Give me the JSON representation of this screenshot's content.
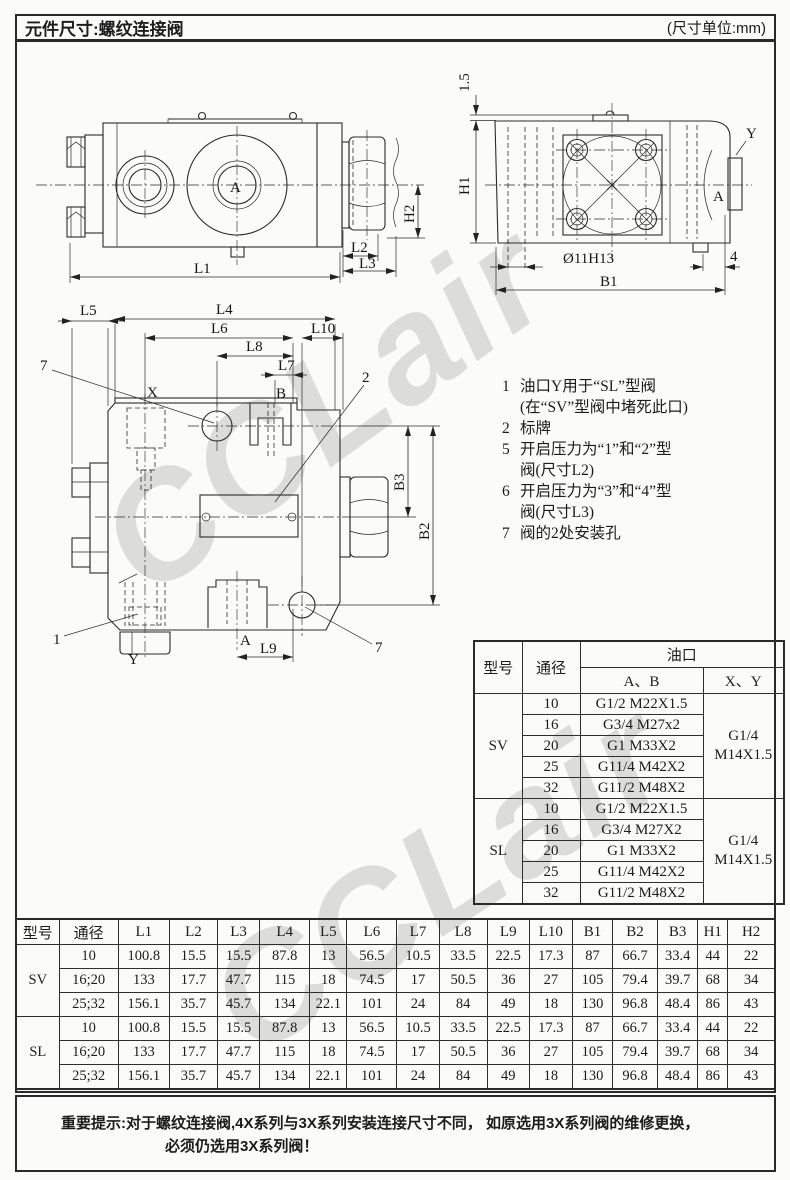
{
  "header": {
    "title": "元件尺寸:螺纹连接阀",
    "unit": "(尺寸单位:mm)"
  },
  "watermark": "CCLair",
  "drawings": {
    "side_view": {
      "labels": {
        "A": "A",
        "L1": "L1",
        "L2": "L2",
        "L3": "L3",
        "H2": "H2"
      }
    },
    "end_view": {
      "labels": {
        "gap": "1.5",
        "H1": "H1",
        "hole": "Ø11H13",
        "B1": "B1",
        "offset4": "4",
        "Y": "Y",
        "A": "A"
      }
    },
    "front_view": {
      "labels": {
        "L4": "L4",
        "L5": "L5",
        "L6": "L6",
        "L7": "L7",
        "L8": "L8",
        "L9": "L9",
        "L10": "L10",
        "B2": "B2",
        "B3": "B3",
        "X": "X",
        "B": "B",
        "A": "A",
        "Y": "Y",
        "c1": "1",
        "c2": "2",
        "c7": "7"
      }
    }
  },
  "notes": [
    {
      "num": "1",
      "lines": [
        "油口Y用于“SL”型阀",
        "(在“SV”型阀中堵死此口)"
      ]
    },
    {
      "num": "2",
      "lines": [
        "标牌"
      ]
    },
    {
      "num": "5",
      "lines": [
        "开启压力为“1”和“2”型",
        "阀(尺寸L2)"
      ]
    },
    {
      "num": "6",
      "lines": [
        "开启压力为“3”和“4”型",
        "阀(尺寸L3)"
      ]
    },
    {
      "num": "7",
      "lines": [
        "阀的2处安装孔"
      ]
    }
  ],
  "port_table": {
    "headers": {
      "model": "型号",
      "size": "通径",
      "port": "油口",
      "ab": "A、B",
      "xy": "X、Y"
    },
    "groups": [
      {
        "model": "SV",
        "xy": [
          "G1/4",
          "M14X1.5"
        ],
        "rows": [
          [
            "10",
            "G1/2 M22X1.5"
          ],
          [
            "16",
            "G3/4 M27x2"
          ],
          [
            "20",
            "G1 M33X2"
          ],
          [
            "25",
            "G11/4 M42X2"
          ],
          [
            "32",
            "G11/2 M48X2"
          ]
        ]
      },
      {
        "model": "SL",
        "xy": [
          "G1/4",
          "M14X1.5"
        ],
        "rows": [
          [
            "10",
            "G1/2 M22X1.5"
          ],
          [
            "16",
            "G3/4 M27X2"
          ],
          [
            "20",
            "G1 M33X2"
          ],
          [
            "25",
            "G11/4 M42X2"
          ],
          [
            "32",
            "G11/2 M48X2"
          ]
        ]
      }
    ]
  },
  "dim_table": {
    "headers": [
      "型号",
      "通径",
      "L1",
      "L2",
      "L3",
      "L4",
      "L5",
      "L6",
      "L7",
      "L8",
      "L9",
      "L10",
      "B1",
      "B2",
      "B3",
      "H1",
      "H2"
    ],
    "groups": [
      {
        "model": "SV",
        "rows": [
          [
            "10",
            "100.8",
            "15.5",
            "15.5",
            "87.8",
            "13",
            "56.5",
            "10.5",
            "33.5",
            "22.5",
            "17.3",
            "87",
            "66.7",
            "33.4",
            "44",
            "22"
          ],
          [
            "16;20",
            "133",
            "17.7",
            "47.7",
            "115",
            "18",
            "74.5",
            "17",
            "50.5",
            "36",
            "27",
            "105",
            "79.4",
            "39.7",
            "68",
            "34"
          ],
          [
            "25;32",
            "156.1",
            "35.7",
            "45.7",
            "134",
            "22.1",
            "101",
            "24",
            "84",
            "49",
            "18",
            "130",
            "96.8",
            "48.4",
            "86",
            "43"
          ]
        ]
      },
      {
        "model": "SL",
        "rows": [
          [
            "10",
            "100.8",
            "15.5",
            "15.5",
            "87.8",
            "13",
            "56.5",
            "10.5",
            "33.5",
            "22.5",
            "17.3",
            "87",
            "66.7",
            "33.4",
            "44",
            "22"
          ],
          [
            "16;20",
            "133",
            "17.7",
            "47.7",
            "115",
            "18",
            "74.5",
            "17",
            "50.5",
            "36",
            "27",
            "105",
            "79.4",
            "39.7",
            "68",
            "34"
          ],
          [
            "25;32",
            "156.1",
            "35.7",
            "45.7",
            "134",
            "22.1",
            "101",
            "24",
            "84",
            "49",
            "18",
            "130",
            "96.8",
            "48.4",
            "86",
            "43"
          ]
        ]
      }
    ]
  },
  "warning": {
    "prefix": "重要提示:",
    "line1": "对于螺纹连接阀,4X系列与3X系列安装连接尺寸不同， 如原选用3X系列阀的维修更换，",
    "line2": "必须仍选用3X系列阀！"
  }
}
